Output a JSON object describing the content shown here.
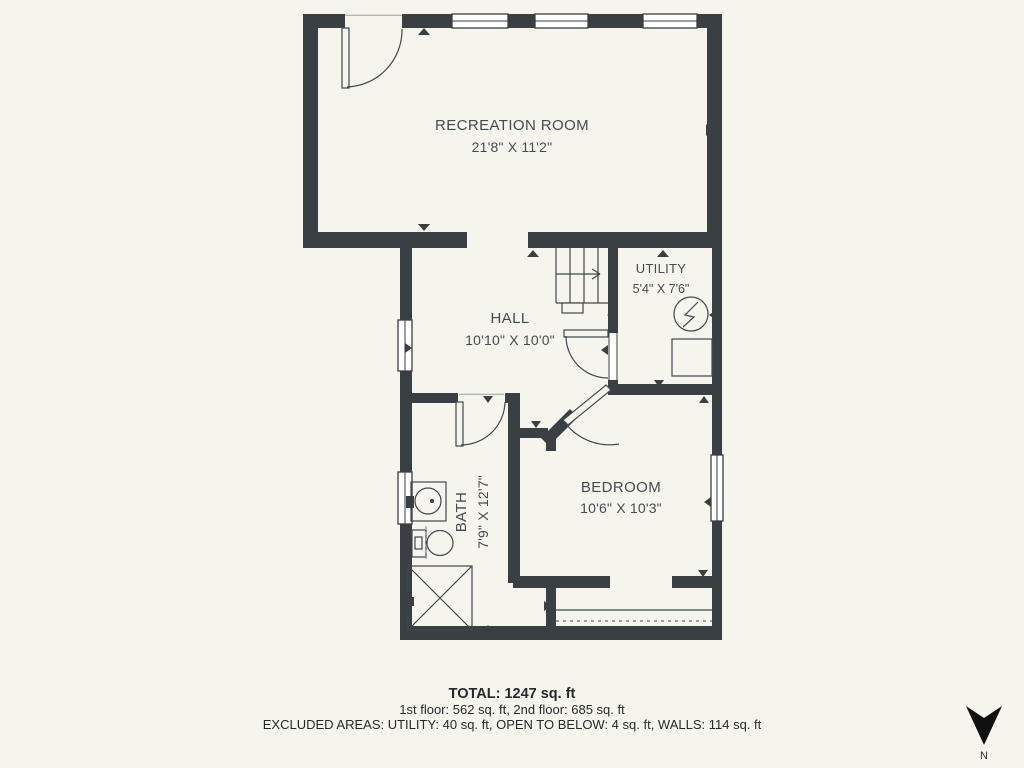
{
  "colors": {
    "background": "#f6f5ed",
    "wall": "#3a3f43",
    "line": "#41474c",
    "label_text": "#454b50",
    "summary_text": "#26292b",
    "window_fill": "#ffffff"
  },
  "rooms": [
    {
      "name": "RECREATION ROOM",
      "dims": "21'8\" X 11'2\""
    },
    {
      "name": "HALL",
      "dims": "10'10\" X 10'0\""
    },
    {
      "name": "UTILITY",
      "dims": "5'4\" X 7'6\""
    },
    {
      "name": "BATH",
      "dims": "7'9\" X 12'7\""
    },
    {
      "name": "BEDROOM",
      "dims": "10'6\" X 10'3\""
    }
  ],
  "summary": {
    "total": "TOTAL: 1247 sq. ft",
    "floors": "1st floor: 562 sq. ft, 2nd floor: 685 sq. ft",
    "excluded": "EXCLUDED AREAS: UTILITY: 40 sq. ft, OPEN TO BELOW: 4 sq. ft, WALLS: 114 sq. ft"
  },
  "compass": {
    "north_label": "N"
  },
  "icons": {
    "compass": "north-arrow",
    "utility_symbol": "electrical-panel",
    "stairs": "staircase-with-up-arrow",
    "bath_fixtures": [
      "sink",
      "toilet",
      "shower"
    ]
  }
}
